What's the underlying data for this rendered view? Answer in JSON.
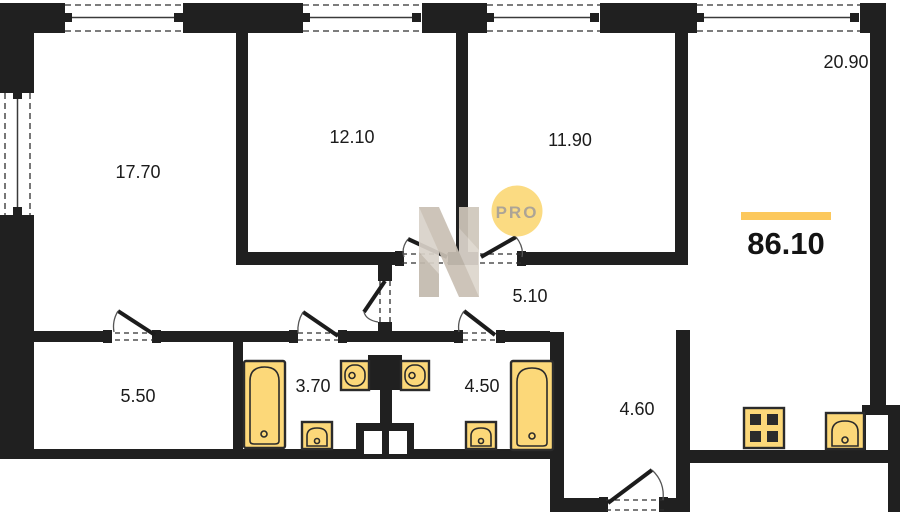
{
  "title": "Apartment floor plan",
  "total_area": {
    "value": "86.10",
    "underline_color": "#fcc85c"
  },
  "rooms": [
    {
      "id": "room-17-70",
      "area": "17.70"
    },
    {
      "id": "room-12-10",
      "area": "12.10"
    },
    {
      "id": "room-11-90",
      "area": "11.90"
    },
    {
      "id": "room-20-90",
      "area": "20.90"
    },
    {
      "id": "corridor-5-10",
      "area": "5.10"
    },
    {
      "id": "room-5-50",
      "area": "5.50"
    },
    {
      "id": "bathroom-3-70",
      "area": "3.70"
    },
    {
      "id": "bathroom-4-50",
      "area": "4.50"
    },
    {
      "id": "hall-4-60",
      "area": "4.60"
    }
  ],
  "watermark": {
    "logo_text": "PRO",
    "circle_color": "#fbd978",
    "text_color": "#a79d8e",
    "letter_light": "#d9d2c9",
    "letter_mid": "#c9c0b4",
    "letter_dark": "#c3baae"
  },
  "colors": {
    "wall": "#202020",
    "background": "#ffffff",
    "fixture_fill": "#fcd879",
    "fixture_stroke": "#2b2b2b"
  }
}
